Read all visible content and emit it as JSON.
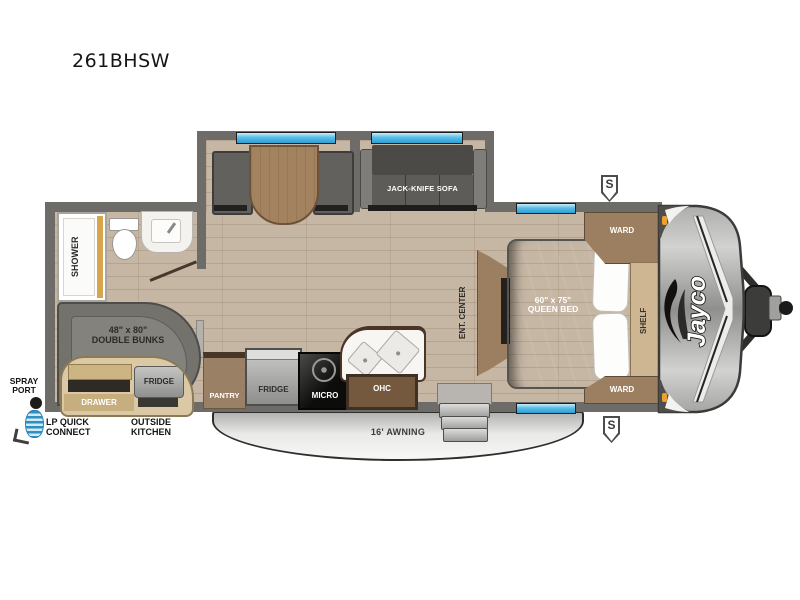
{
  "model": "261BHSW",
  "brand_logo": "Jayco",
  "speaker_symbol": "S",
  "colors": {
    "wall": "#6e6c68",
    "floor": "#c6b6a4",
    "window_glass": "#59bde6",
    "cabinet_wood": "#9b7f60",
    "furniture_gray": "#6f6e6a",
    "exterior_tan": "#dbc9a6",
    "awning_gray": "#e9e9e7",
    "marker_orange": "#efa12f",
    "hose_blue": "#2e8fc0"
  },
  "slide_out": {
    "sofa": "JACK-KNIFE SOFA"
  },
  "bathroom": {
    "shower": "SHOWER"
  },
  "bunk_room": {
    "size": "48\" x 80\"",
    "name": "DOUBLE BUNKS"
  },
  "outside_kitchen": {
    "fridge": "FRIDGE",
    "drawer": "DRAWER"
  },
  "kitchen": {
    "pantry": "PANTRY",
    "fridge": "FRIDGE",
    "micro": "MICRO",
    "ohc": "OHC"
  },
  "bedroom": {
    "ent_center": "ENT. CENTER",
    "bed_size": "60\" x 75\"",
    "bed_name": "QUEEN BED",
    "ward_top": "WARD",
    "ward_bottom": "WARD",
    "shelf": "SHELF"
  },
  "exterior_labels": {
    "spray_port_line1": "SPRAY",
    "spray_port_line2": "PORT",
    "lp_line1": "LP QUICK",
    "lp_line2": "CONNECT",
    "outside_kitchen_line1": "OUTSIDE",
    "outside_kitchen_line2": "KITCHEN",
    "awning": "16' AWNING"
  }
}
